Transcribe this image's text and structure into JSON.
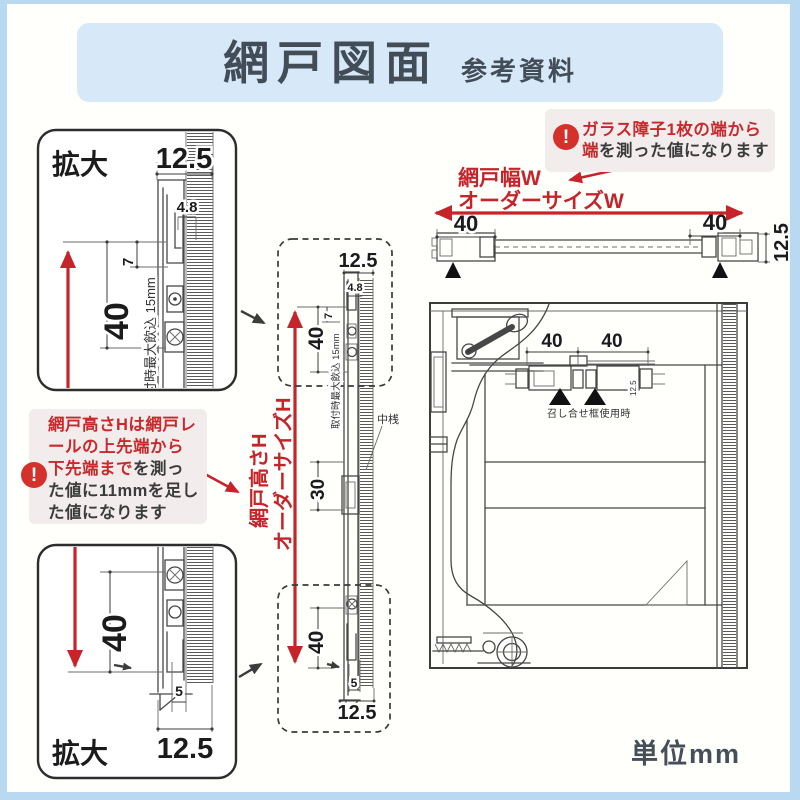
{
  "page": {
    "border_color": "#b9d9f2",
    "background": "#ffffff"
  },
  "header": {
    "title": "網戸図面",
    "subtitle": "参考資料",
    "bg": "#d7e8f8",
    "text_color": "#424d58"
  },
  "footer": {
    "unit_label": "単位mm"
  },
  "colors": {
    "red": "#c5242b",
    "note_bg": "#f2ecec",
    "warning_red": "#d5312c",
    "line": "#474747"
  },
  "annotations": {
    "warning_glyph": "!",
    "width_note": {
      "line1": "ガラス障子1枚の端から",
      "line2_red": "端",
      "line2_black": "を測った値になります"
    },
    "height_note": {
      "line1": "網戸高さHは網戸レ",
      "line2": "ールの上先端から",
      "line3_red": "下先端まで",
      "line3_black": "を測っ",
      "line4": "た値に11mmを足し",
      "line5": "た値になります"
    }
  },
  "labels": {
    "zoom": "拡大",
    "net_width": "網戸幅W",
    "order_width": "オーダーサイズW",
    "net_height": "網戸高さH",
    "order_height": "オーダーサイズH",
    "middle_rail": "中桟",
    "meeting_stile_note": "召し合せ框使用時",
    "max_engagement": "取付時最大飲込 15mm"
  },
  "dims": {
    "d125": "12.5",
    "d48": "4.8",
    "d7": "7",
    "d40": "40",
    "d30": "30",
    "d5": "5"
  }
}
